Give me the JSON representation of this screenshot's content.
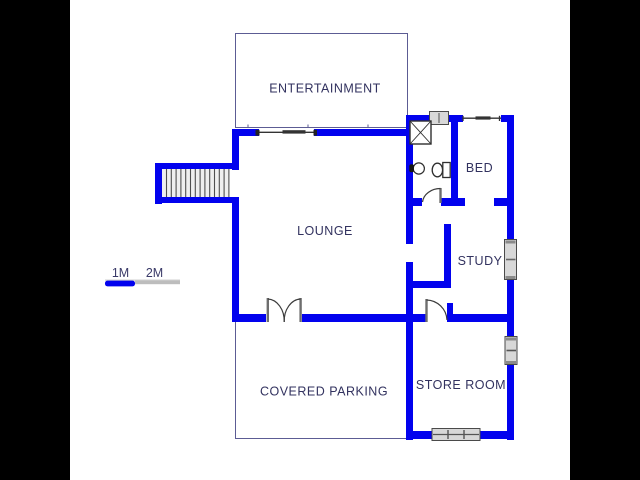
{
  "figure": {
    "type": "floor-plan",
    "description": "Single storey house floor plan with letterboxed black side bars"
  },
  "labels": {
    "entertainment": "ENTERTAINMENT",
    "lounge": "LOUNGE",
    "bed": "BED",
    "study": "STUDY",
    "store_room": "STORE ROOM",
    "covered_parking": "COVERED PARKING"
  },
  "scale_bar": {
    "label_1m": "1M",
    "label_2m": "2M"
  },
  "colors": {
    "wall_blue": "#0202ee",
    "room_outline": "#5c5c94",
    "label_text": "#32325f",
    "scale_blue": "#0202ee",
    "scale_gray": "#bdbdbd",
    "letterbox": "#000000",
    "background": "#ffffff"
  }
}
